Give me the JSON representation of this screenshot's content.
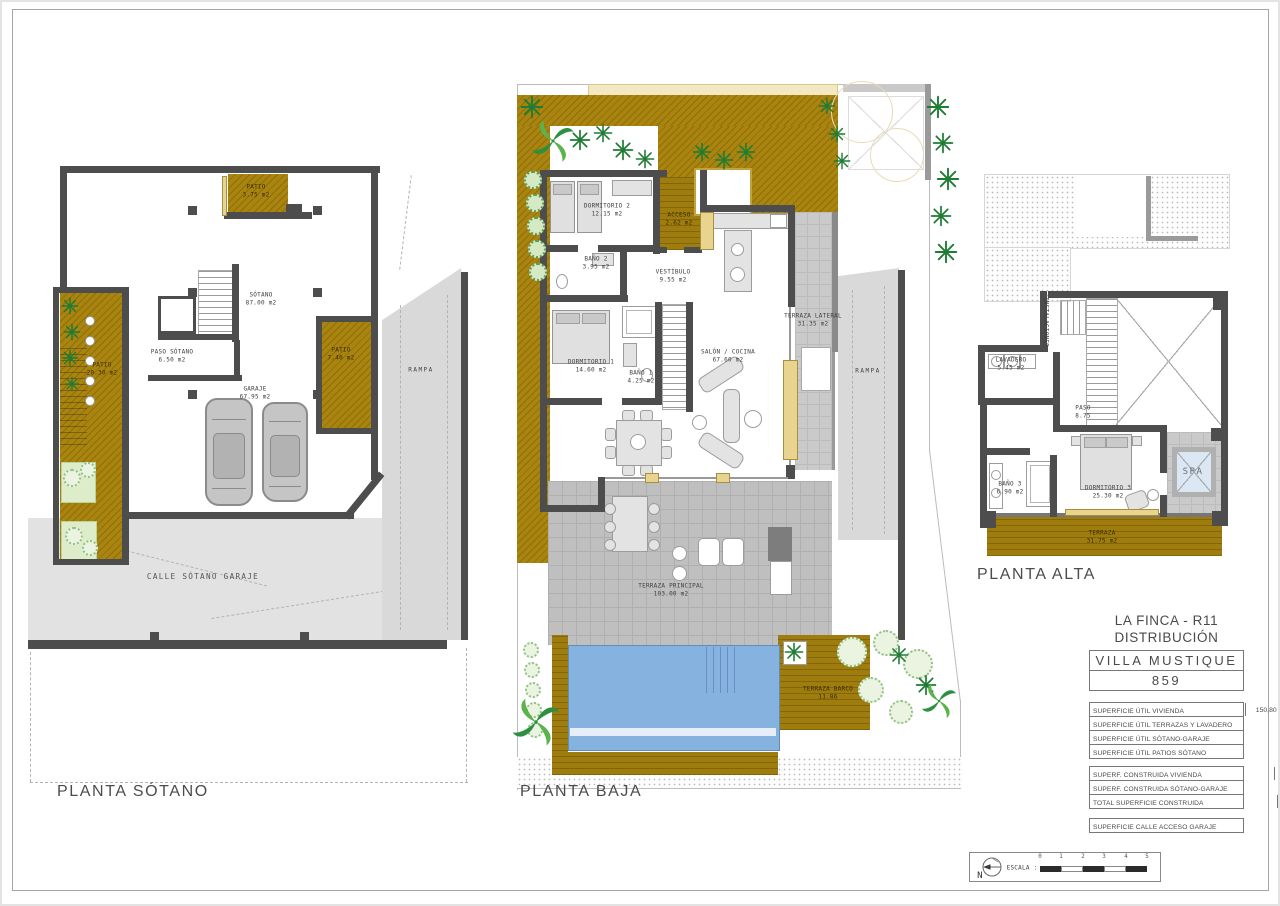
{
  "plans": {
    "sotano": {
      "title": "PLANTA SÓTANO",
      "rampa": "RAMPA",
      "calle": "CALLE SÓTANO GARAJE",
      "rooms": {
        "patio_top": {
          "name": "PATIO",
          "area": "3.75 m2"
        },
        "main": {
          "name": "SÓTANO",
          "area": "87.00 m2"
        },
        "paso": {
          "name": "PASO SÓTANO",
          "area": "6.50 m2"
        },
        "patio_left": {
          "name": "PATIO",
          "area": "20.30 m2"
        },
        "patio_right": {
          "name": "PATIO",
          "area": "7.40 m2"
        },
        "garaje": {
          "name": "GARAJE",
          "area": "67.95 m2"
        }
      }
    },
    "baja": {
      "title": "PLANTA BAJA",
      "rampa": "RAMPA",
      "rooms": {
        "dormitorio2": {
          "name": "DORMITORIO 2",
          "area": "12.15 m2"
        },
        "bano2": {
          "name": "BAÑO 2",
          "area": "3.95 m2"
        },
        "acceso": {
          "name": "ACCESO",
          "area": "2.62 m2"
        },
        "vestibulo": {
          "name": "VESTÍBULO",
          "area": "9.55 m2"
        },
        "dormitorio1": {
          "name": "DORMITORIO 1",
          "area": "14.60 m2"
        },
        "bano1": {
          "name": "BAÑO 1",
          "area": "4.25 m2"
        },
        "salon": {
          "name": "SALÓN / COCINA",
          "area": "67.60 m2"
        },
        "terraza_lateral": {
          "name": "TERRAZA LATERAL",
          "area": "31.35 m2"
        },
        "terraza_principal": {
          "name": "TERRAZA PRINCIPAL",
          "area": "103.00 m2"
        },
        "terraza_barco": {
          "name": "TERRAZA BARCO",
          "area": "11.86"
        }
      }
    },
    "alta": {
      "title": "PLANTA ALTA",
      "rooms": {
        "lavadero": {
          "name": "LAVADERO",
          "area": "5.45 m2"
        },
        "instalaciones": {
          "name": "INSTALACIONES"
        },
        "paso": {
          "name": "PASO",
          "area": "8.75"
        },
        "bano3": {
          "name": "BAÑO 3",
          "area": "6.90 m2"
        },
        "dormitorio3": {
          "name": "DORMITORIO 3",
          "area": "25.30 m2"
        },
        "spa": {
          "name": "SPA"
        },
        "terraza": {
          "name": "TERRAZA",
          "area": "31.75 m2"
        }
      }
    }
  },
  "title_block": {
    "project": "LA FINCA - R11",
    "subtitle": "DISTRIBUCIÓN",
    "villa_name": "VILLA MUSTIQUE",
    "villa_number": "859",
    "table_util": [
      {
        "label": "SUPERFICIE ÚTIL VIVIENDA",
        "value": "150,80"
      },
      {
        "label": "SUPERFICIE ÚTIL TERRAZAS Y LAVADERO",
        "value": "179,35"
      },
      {
        "label": "SUPERFICIE ÚTIL SÓTANO-GARAJE",
        "value": "161,35"
      },
      {
        "label": "SUPERFICIE ÚTIL PATIOS SÓTANO",
        "value": "31,65"
      }
    ],
    "table_construida": [
      {
        "label": "SUPERF. CONSTRUIDA VIVIENDA",
        "value": "203,22"
      },
      {
        "label": "SUPERF. CONSTRUIDA SÓTANO-GARAJE",
        "value": "195,50"
      },
      {
        "label": "TOTAL SUPERFICIE CONSTRUIDA",
        "value": "398,72"
      }
    ],
    "table_calle": [
      {
        "label": "SUPERFICIE CALLE ACCESO GARAJE",
        "value": "77,96"
      }
    ]
  },
  "scale_bar": {
    "north": "N",
    "label": "ESCALA :",
    "ticks": [
      "0",
      "1",
      "2",
      "3",
      "4",
      "5"
    ]
  }
}
